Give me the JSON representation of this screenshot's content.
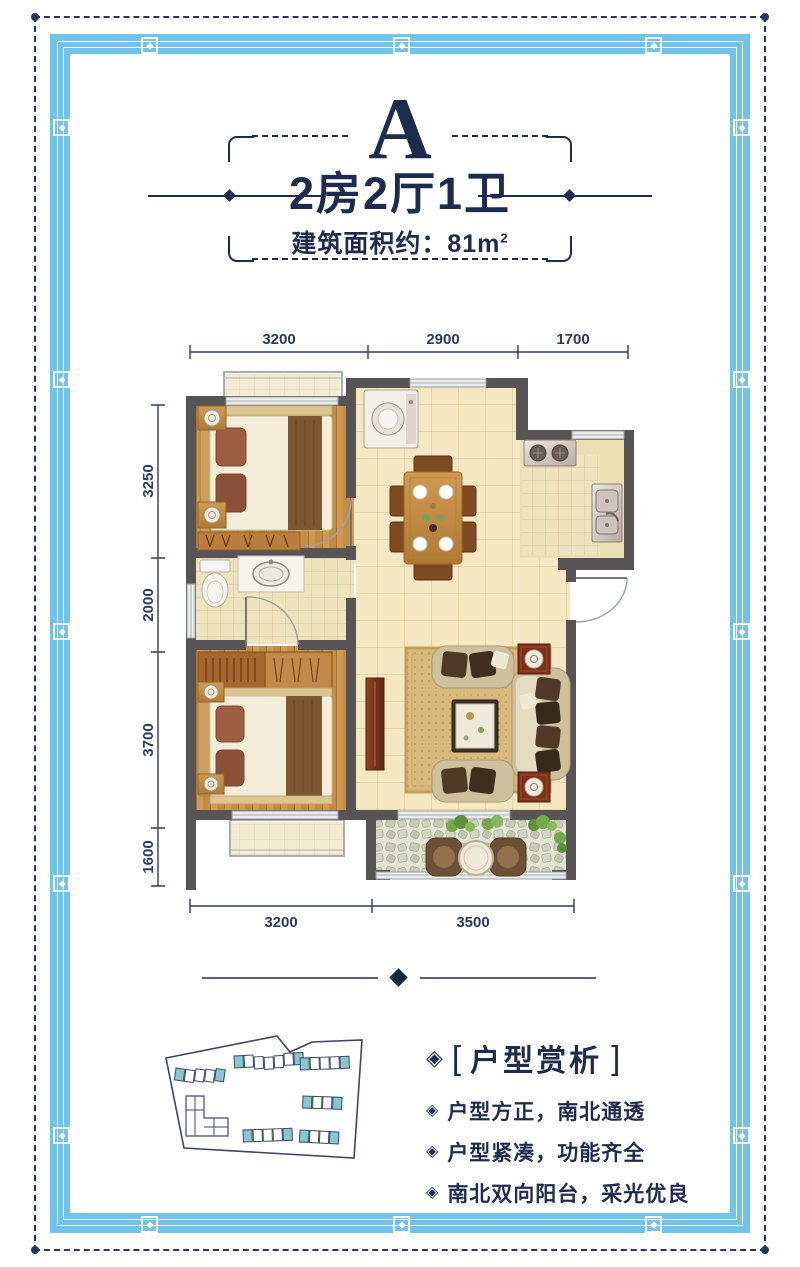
{
  "header": {
    "plan_letter": "A",
    "title": "2房2厅1卫",
    "area_prefix": "建筑面积约：81m",
    "area_sup": "2"
  },
  "floor_plan": {
    "dimensions": {
      "top": [
        "3200",
        "2900",
        "1700"
      ],
      "left": [
        "3250",
        "2000",
        "3700",
        "1600"
      ],
      "bottom": [
        "3200",
        "3500"
      ]
    }
  },
  "features": {
    "icon": "◈",
    "bracket_left": "[",
    "heading": "户型赏析",
    "bracket_right": "]",
    "items": [
      "户型方正，南北通透",
      "户型紧凑，功能齐全",
      "南北双向阳台，采光优良"
    ]
  },
  "colors": {
    "navy": "#1d2c4e",
    "border_blue": "#72c3e9",
    "wall_gray": "#585354",
    "teal_accent": "#86c8cf",
    "wood_floor": "#cf9950",
    "tile_cream": "#f4e7c2"
  }
}
